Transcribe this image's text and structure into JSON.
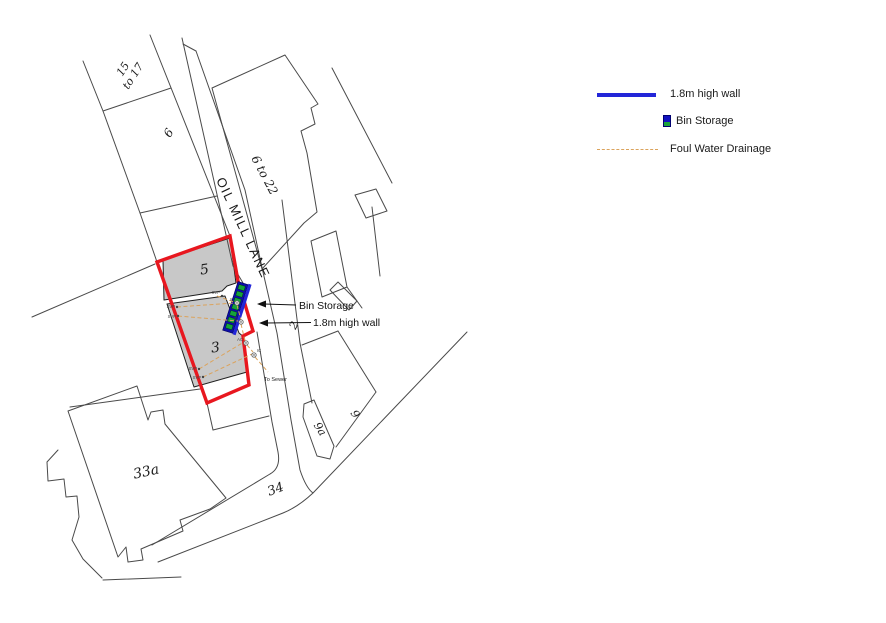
{
  "colors": {
    "site_boundary_red": "#e8171f",
    "building_fill_gray": "#c8c8c8",
    "wall_blue": "#2326d8",
    "bin_body_navy": "#0d0da8",
    "bin_green": "#16a33a",
    "drainage_orange": "#dba35c",
    "linework_gray": "#4a4a4a"
  },
  "map": {
    "street_label": "OIL MILL LANE",
    "parcel_labels": {
      "p15": "15",
      "p15b": "to 17",
      "p6": "6",
      "p6_22": "6 to 22",
      "p5": "5",
      "p3": "3",
      "p2": "2",
      "p9": "9",
      "p9a": "9a",
      "p34": "34",
      "p33a": "33a"
    },
    "annotations": {
      "bin_storage": "Bin Storage",
      "high_wall": "1.8m high wall",
      "to_sewer": "To Sewer"
    },
    "marker_labels": {
      "svp": "SVP",
      "ic": "IC",
      "ac": "AC"
    }
  },
  "legend": {
    "items": [
      {
        "key": "wall",
        "label": "1.8m high wall"
      },
      {
        "key": "bin",
        "label": "Bin Storage"
      },
      {
        "key": "drainage",
        "label": "Foul Water Drainage"
      }
    ]
  }
}
